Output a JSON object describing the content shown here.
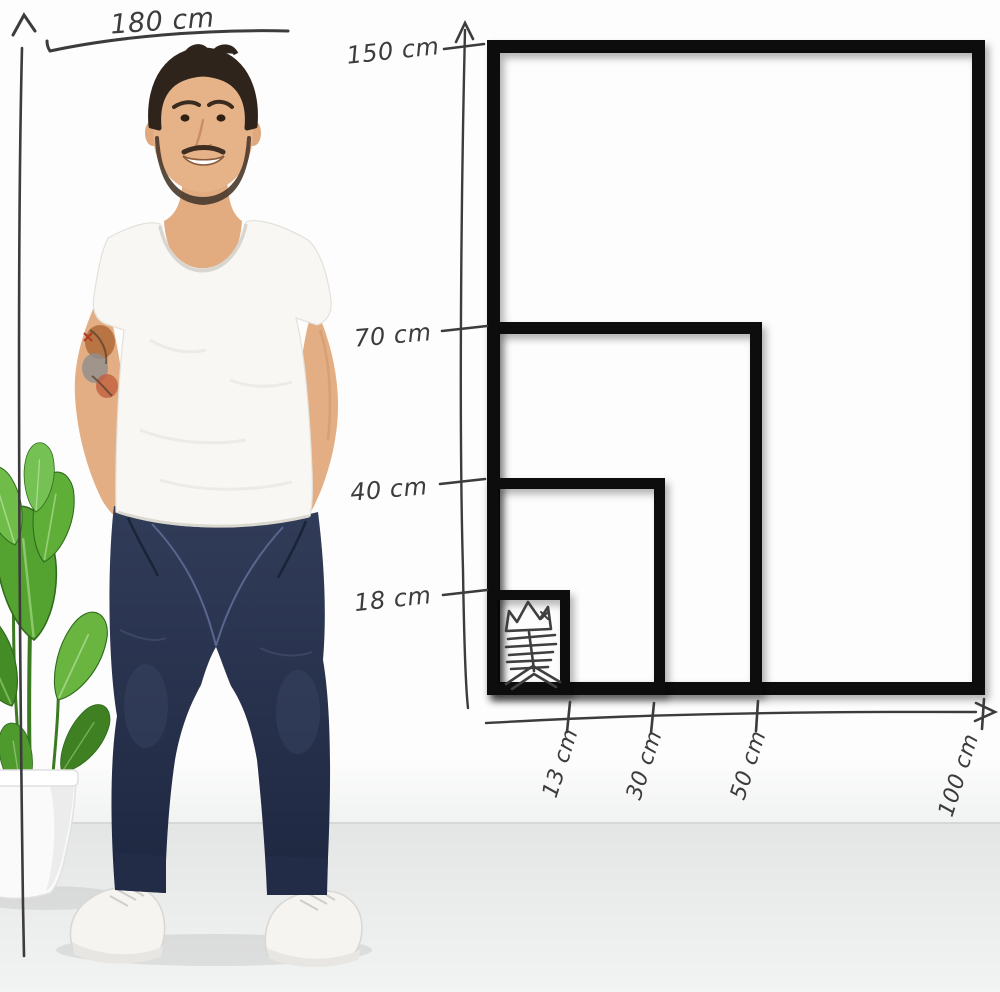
{
  "person": {
    "height_label": "180 cm"
  },
  "vertical_axis": {
    "unit": "cm",
    "labels": [
      "150 cm",
      "70 cm",
      "40 cm",
      "18 cm"
    ]
  },
  "horizontal_axis": {
    "unit": "cm",
    "labels": [
      "13 cm",
      "30 cm",
      "50 cm",
      "100 cm"
    ]
  },
  "frames": [
    {
      "width_cm": 100,
      "height_cm": 150,
      "width_label": "100 cm",
      "height_label": "150 cm"
    },
    {
      "width_cm": 50,
      "height_cm": 70,
      "width_label": "50 cm",
      "height_label": "70 cm"
    },
    {
      "width_cm": 30,
      "height_cm": 40,
      "width_label": "30 cm",
      "height_label": "40 cm"
    },
    {
      "width_cm": 13,
      "height_cm": 18,
      "width_label": "13 cm",
      "height_label": "18 cm"
    }
  ],
  "colors": {
    "frame_black": "#0c0c0c",
    "sketch_line": "#3c3c3c",
    "wall_white": "#fdfdfd",
    "floor_gray": "#e9eaea",
    "jeans_navy": "#2b3550",
    "leaf_green": "#55a031",
    "skin": "#e6b389"
  }
}
